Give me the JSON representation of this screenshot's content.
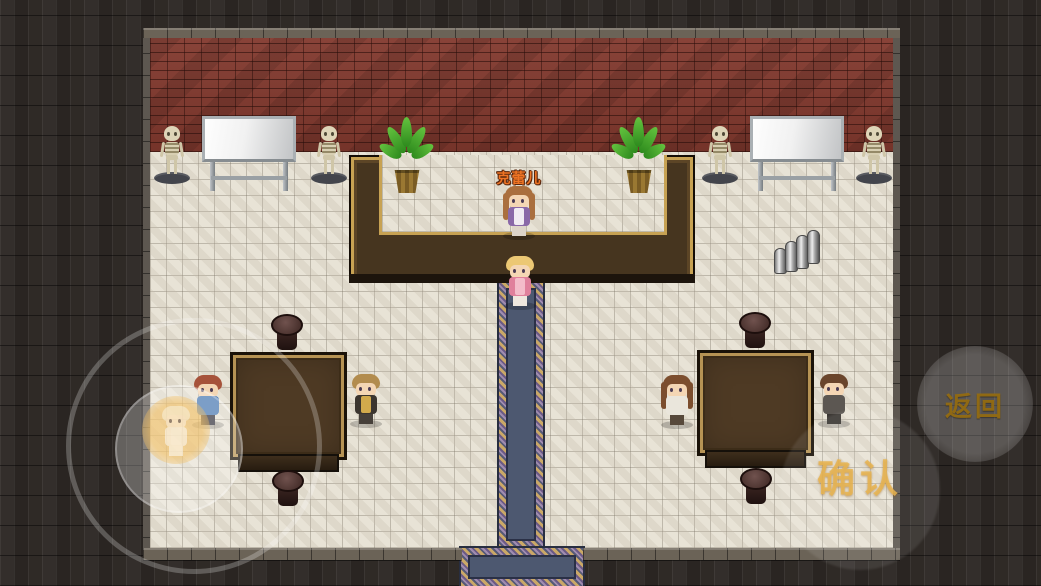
{
  "scene_type": "rpg-tavern-interior",
  "hud": {
    "npc_name_label": "克蕾儿",
    "back_button_label": "返回",
    "confirm_button_label": "确认",
    "joystick": "virtual-joystick"
  },
  "colors": {
    "name_label_orange": "#ef7424",
    "hud_button_gold": "#946c12",
    "confirm_gold": "#e9b551",
    "brick_wall_red": "#82392e",
    "floor_tile": "#e8e3d6",
    "counter_wood": "#46351f",
    "counter_trim_gold": "#c7a253",
    "carpet_blue": "#4d5870",
    "border_wall_dark": "#2b2724",
    "table_wood": "#4e3a24"
  },
  "entities": {
    "characters": [
      {
        "name": "bartender",
        "label": "克蕾儿"
      },
      {
        "name": "player-character"
      },
      {
        "name": "seated-npc-left-table-west"
      },
      {
        "name": "seated-npc-left-table-east"
      },
      {
        "name": "seated-npc-right-table-west"
      },
      {
        "name": "seated-npc-right-table-east"
      },
      {
        "name": "joystick-ghost-avatar"
      }
    ],
    "props": [
      {
        "name": "skeleton-statue",
        "count": 4
      },
      {
        "name": "whiteboard",
        "count": 2
      },
      {
        "name": "potted-plant",
        "count": 2
      },
      {
        "name": "bar-counter",
        "count": 1
      },
      {
        "name": "square-table",
        "count": 2
      },
      {
        "name": "stool",
        "count": 4
      },
      {
        "name": "metal-cans",
        "count": 1
      },
      {
        "name": "carpet-runner",
        "count": 1
      },
      {
        "name": "south-doorway",
        "count": 1
      }
    ]
  }
}
